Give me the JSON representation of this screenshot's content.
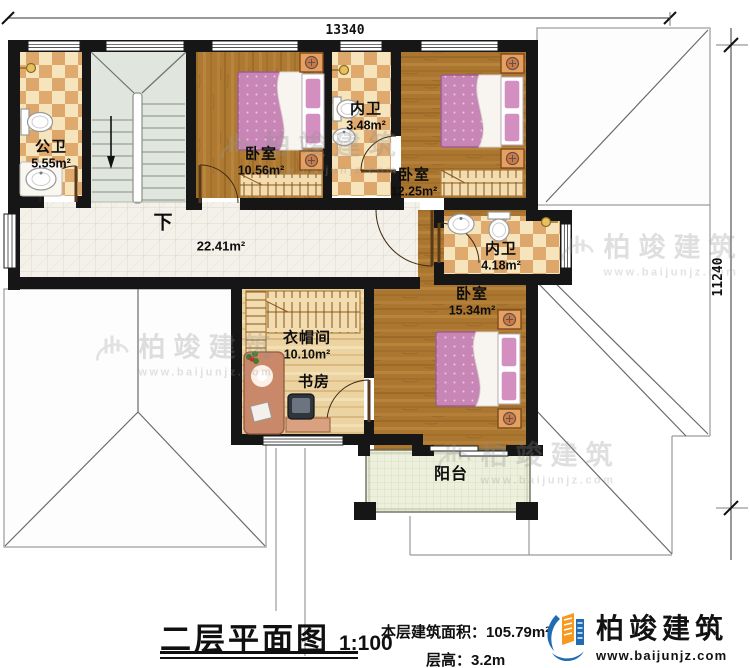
{
  "dimensions": {
    "width_mm": "13340",
    "height_mm": "11240"
  },
  "plan": {
    "rooms": {
      "public_bathroom": {
        "label": "公卫",
        "area": "5.55m²"
      },
      "bedroom_top": {
        "label": "卧室",
        "area": "10.56m²"
      },
      "inner_bathroom_top": {
        "label": "内卫",
        "area": "3.48m²"
      },
      "bedroom_right": {
        "label": "卧室",
        "area": "12.25m²"
      },
      "hall": {
        "area": "22.41m²"
      },
      "inner_bathroom_mid": {
        "label": "内卫",
        "area": "4.18m²"
      },
      "bedroom_bottom": {
        "label": "卧室",
        "area": "15.34m²"
      },
      "cloakroom": {
        "label": "衣帽间",
        "area": "10.10m²"
      },
      "study": {
        "label": "书房"
      },
      "balcony": {
        "label": "阳台"
      }
    },
    "stair_direction": "下"
  },
  "title_block": {
    "title": "二层平面图",
    "scale": "1:100",
    "area_label": "本层建筑面积：",
    "area_value": "105.79m²",
    "height_label": "层高：",
    "height_value": "3.2m"
  },
  "brand": {
    "name": "柏竣建筑",
    "website": "www.baijunjz.com"
  },
  "watermark": {
    "name": "柏竣建筑",
    "website": "www.baijunjz.com"
  },
  "colors": {
    "wall": "#161616",
    "wood_floor": "#ae7a33",
    "pale_wood": "#ecd3a2",
    "checker_light": "#f6e4bd",
    "checker_dark": "#dda76b",
    "stair_floor": "#e0e6dd",
    "hall_tile": "#f3f1ea",
    "bed_pink": "#c886b7",
    "balcony_floor": "#edf0dc",
    "logo_blue": "#1e6cb5",
    "logo_orange": "#f5991f"
  }
}
